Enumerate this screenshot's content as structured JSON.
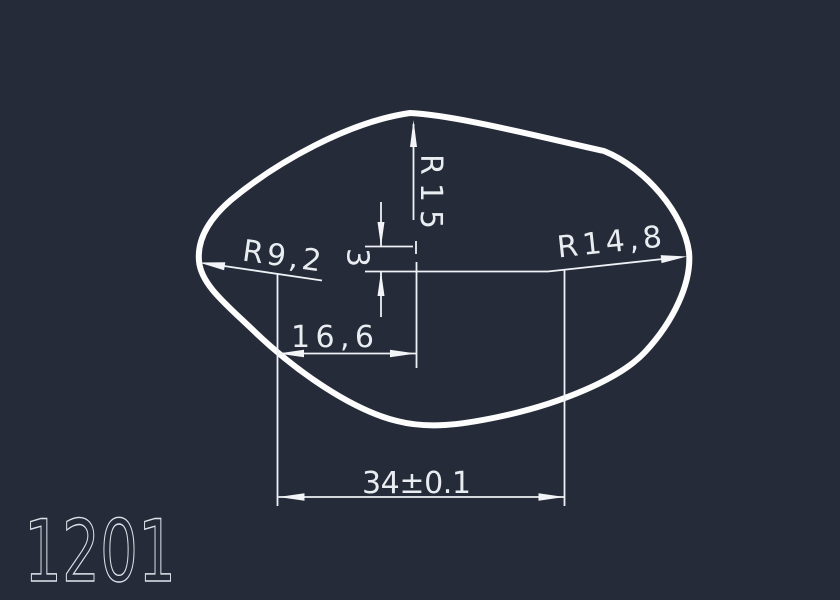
{
  "drawing": {
    "part_number": "1201",
    "colors": {
      "background": "#252b38",
      "dimension_lines": "#eef1f5",
      "profile_outline": "#fdfdfe",
      "text": "#e9edf2"
    },
    "dimensions": [
      {
        "label": "R15",
        "type": "radius",
        "orientation": "vertical"
      },
      {
        "label": "3",
        "type": "linear",
        "orientation": "vertical"
      },
      {
        "label": "R9,2",
        "type": "radius",
        "orientation": "leader-left"
      },
      {
        "label": "R14,8",
        "type": "radius",
        "orientation": "leader-right"
      },
      {
        "label": "16,6",
        "type": "linear",
        "orientation": "horizontal"
      },
      {
        "label": "34±0.1",
        "type": "linear",
        "orientation": "horizontal"
      }
    ]
  }
}
